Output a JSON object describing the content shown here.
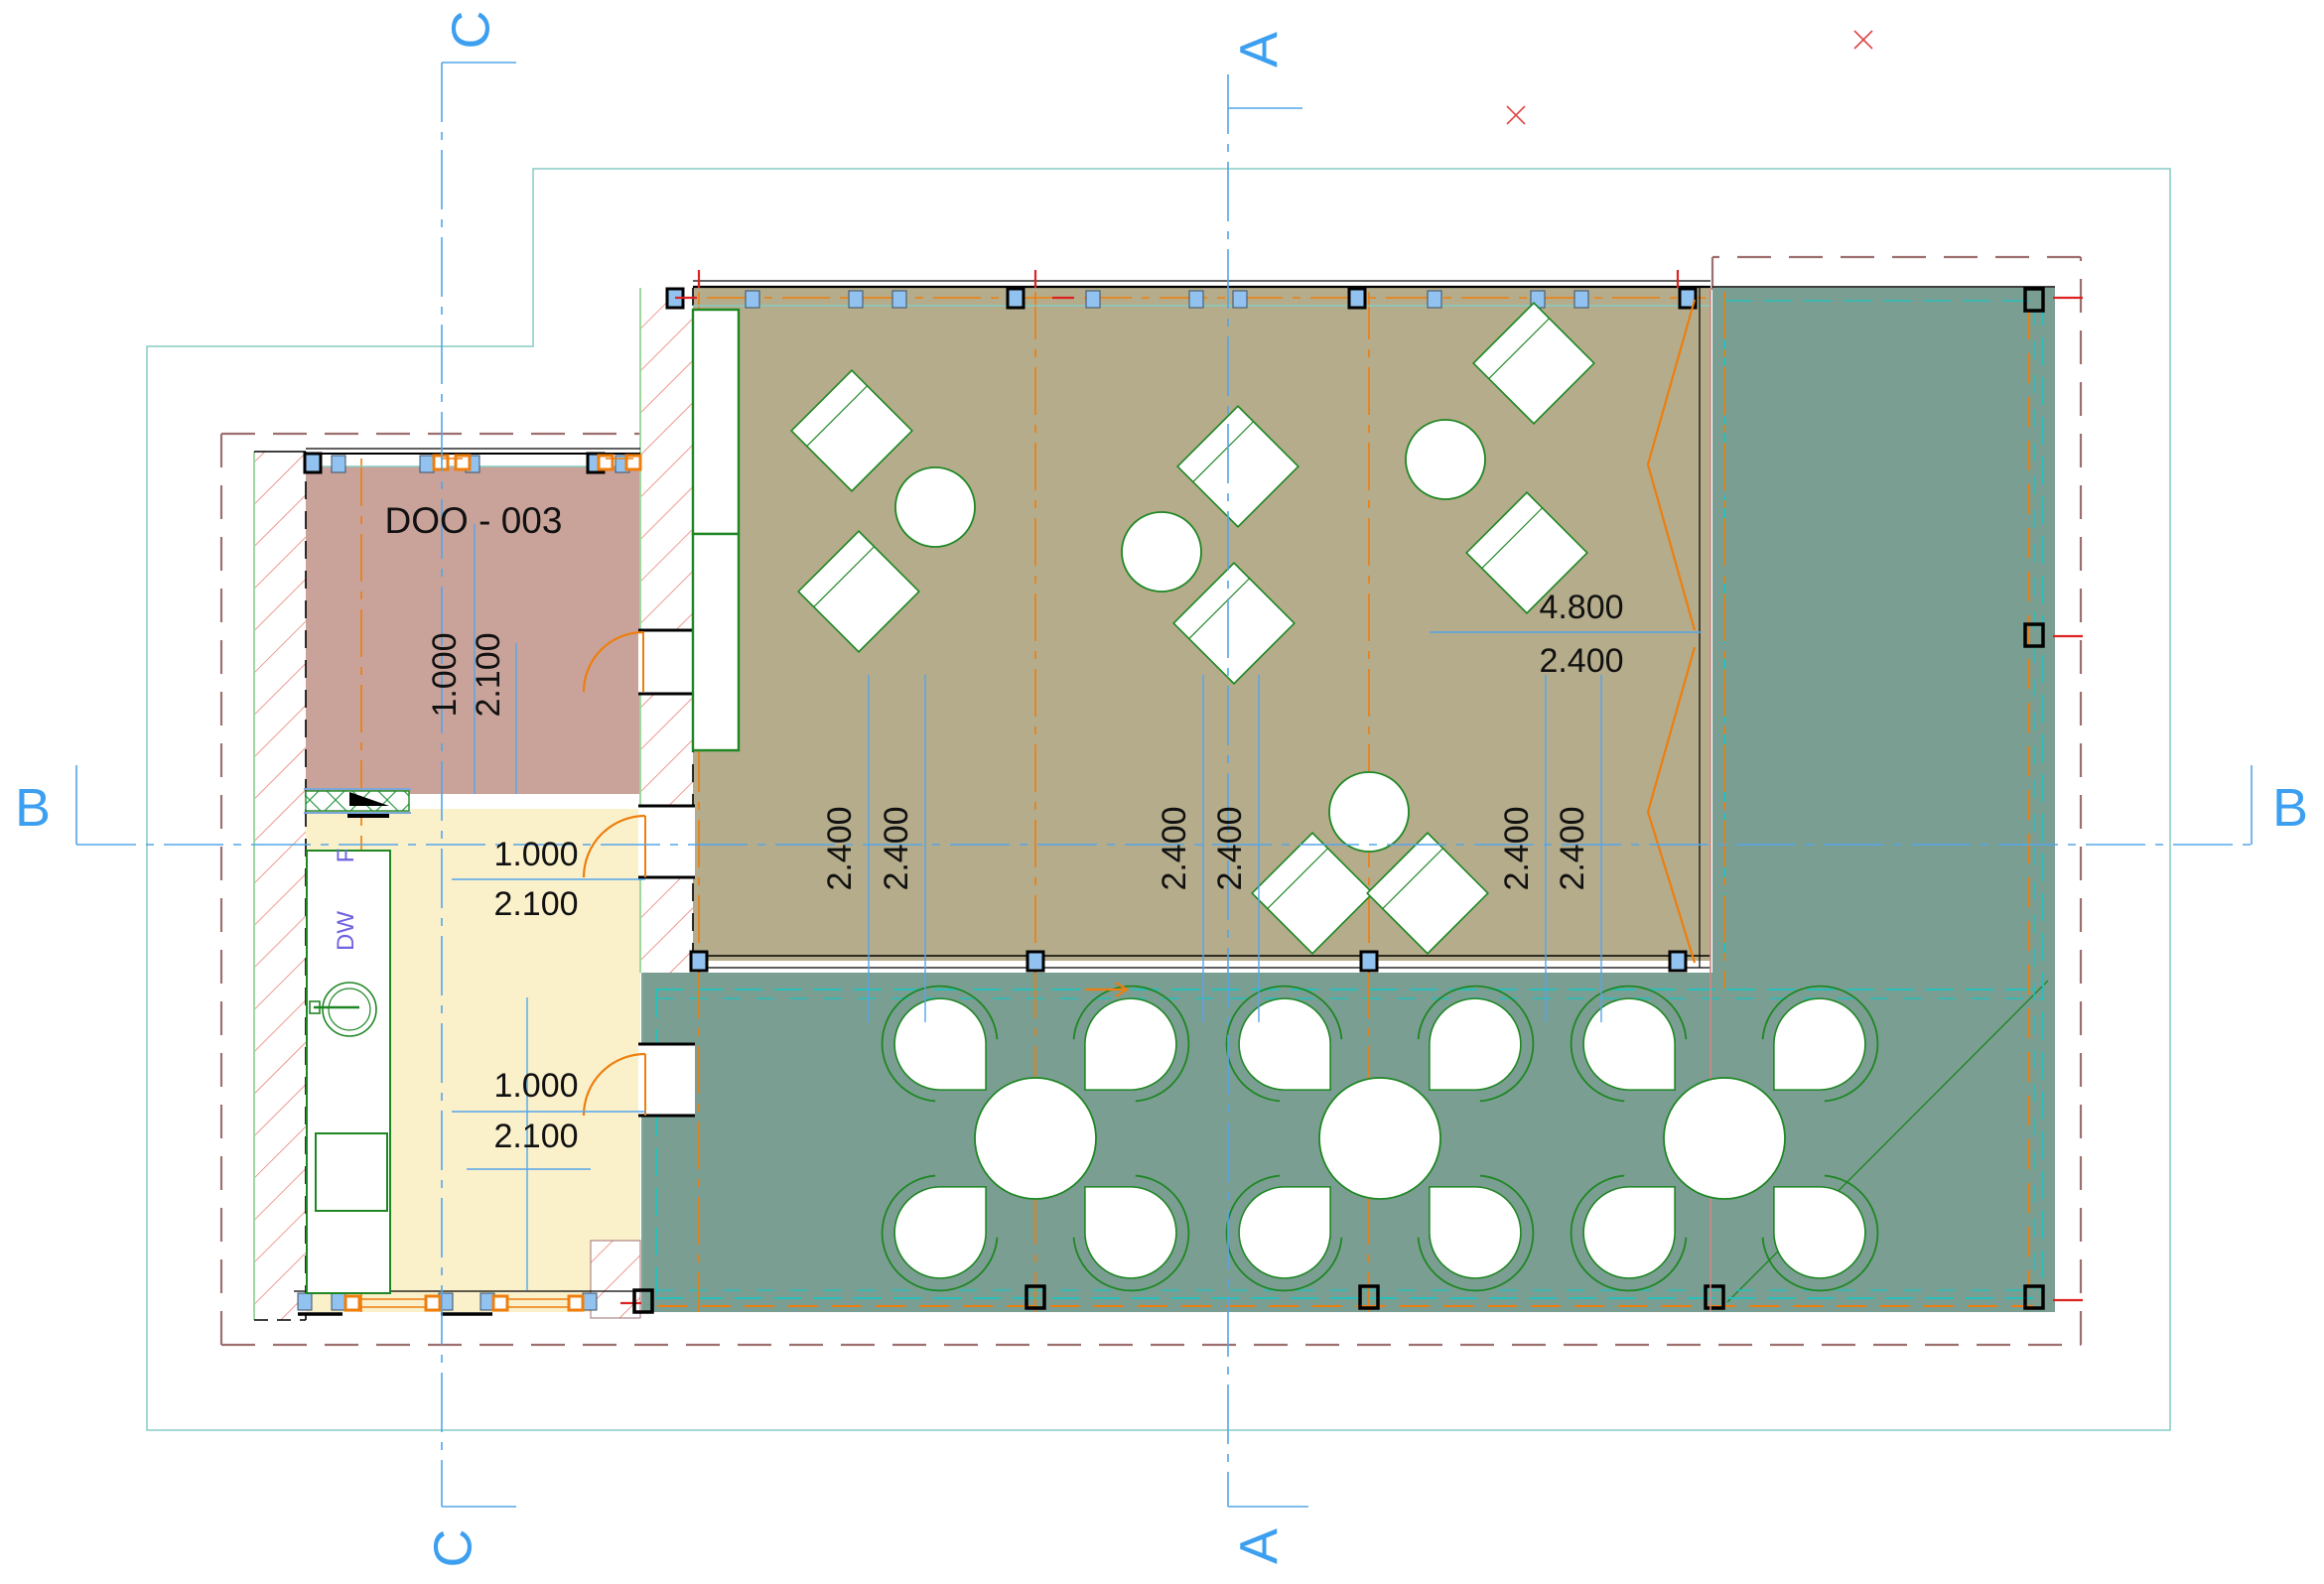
{
  "plan": {
    "room_label": "DOO - 003",
    "appliances": {
      "fridge": "F",
      "dishwasher": "DW"
    },
    "sections": {
      "a": "A",
      "b": "B",
      "c": "C"
    },
    "dims": {
      "doo_door": {
        "w": "1.000",
        "h": "2.100"
      },
      "kitchen_door_upper": {
        "w": "1.000",
        "h": "2.100"
      },
      "kitchen_door_lower": {
        "w": "1.000",
        "h": "2.100"
      },
      "bay": {
        "total": "4.800",
        "half": "2.400"
      },
      "grid": [
        "2.400",
        "2.400",
        "2.400",
        "2.400",
        "2.400",
        "2.400"
      ]
    },
    "colors": {
      "dining_floor": "#b5ac8b",
      "deck_floor": "#7b9e92",
      "kitchen_floor": "#faf0ca",
      "room_floor": "#c9a39a",
      "cad_orange": "#ee7e0d",
      "furniture_green": "#1e8723",
      "deck_dash_cyan": "#28beb9",
      "site_line_teal": "#86cbc3",
      "setback_dash": "#9e6f6f",
      "section_blue": "#3d9ff0",
      "hatch_red": "#e87a6e",
      "window_blue": "#92c2ef"
    }
  }
}
